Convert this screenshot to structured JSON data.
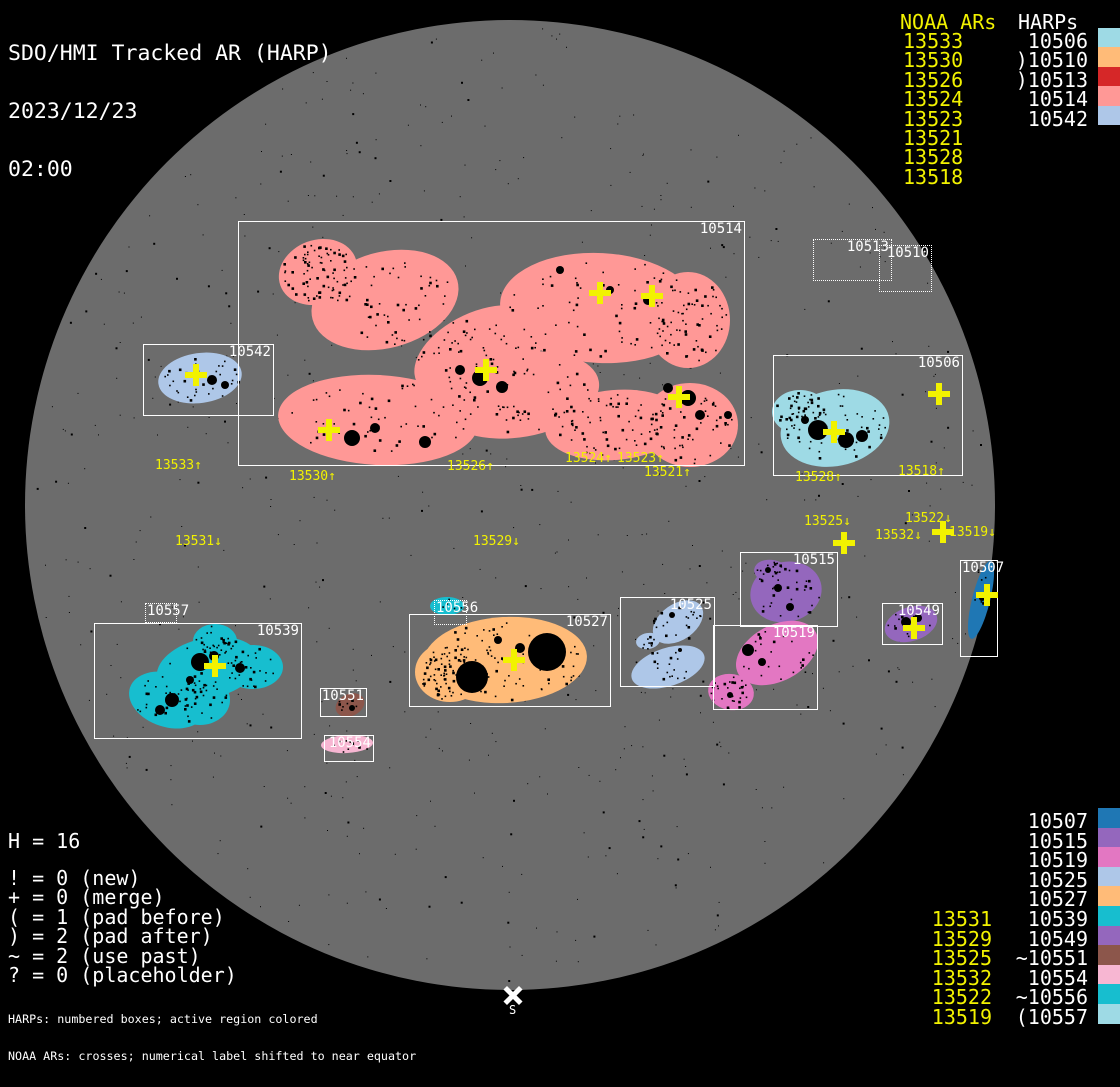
{
  "title": {
    "line1": "SDO/HMI Tracked AR (HARP)",
    "line2": "2023/12/23",
    "line3": "02:00"
  },
  "colors": {
    "background": "#000000",
    "disk": "#6c6c6c",
    "noaa_yellow": "#f2f200",
    "text_white": "#ffffff",
    "box_border": "#ffffff",
    "speckle": "#000000"
  },
  "legend_top_right": {
    "noaa_header": "NOAA ARs",
    "harp_header": "HARPs",
    "rows": [
      {
        "noaa": "13533",
        "harp": "10506",
        "color": "#9edae5"
      },
      {
        "noaa": "13530",
        "harp": ")10510",
        "color": "#ffbb78"
      },
      {
        "noaa": "13526",
        "harp": ")10513",
        "color": "#d62728"
      },
      {
        "noaa": "13524",
        "harp": "10514",
        "color": "#ff9896"
      },
      {
        "noaa": "13523",
        "harp": "10542",
        "color": "#aec7e8"
      },
      {
        "noaa": "13521",
        "harp": "",
        "color": ""
      },
      {
        "noaa": "13528",
        "harp": "",
        "color": ""
      },
      {
        "noaa": "13518",
        "harp": "",
        "color": ""
      }
    ]
  },
  "legend_bottom_right": {
    "rows": [
      {
        "noaa": "",
        "harp": "10507",
        "color": "#1f77b4"
      },
      {
        "noaa": "",
        "harp": "10515",
        "color": "#9467bd"
      },
      {
        "noaa": "",
        "harp": "10519",
        "color": "#e377c2"
      },
      {
        "noaa": "",
        "harp": "10525",
        "color": "#aec7e8"
      },
      {
        "noaa": "",
        "harp": "10527",
        "color": "#ffbb78"
      },
      {
        "noaa": "13531",
        "harp": "10539",
        "color": "#17becf"
      },
      {
        "noaa": "13529",
        "harp": "10549",
        "color": "#9467bd"
      },
      {
        "noaa": "13525",
        "harp": "~10551",
        "color": "#8c564b"
      },
      {
        "noaa": "13532",
        "harp": "10554",
        "color": "#f7b6d2"
      },
      {
        "noaa": "13522",
        "harp": "~10556",
        "color": "#17becf"
      },
      {
        "noaa": "13519",
        "harp": "(10557",
        "color": "#9edae5"
      }
    ]
  },
  "legend_bottom_left": {
    "harp_count": "H = 16",
    "lines": [
      "! = 0 (new)",
      "+ = 0 (merge)",
      "( = 1 (pad before)",
      ") = 2 (pad after)",
      "~ = 2 (use past)",
      "? = 0 (placeholder)"
    ]
  },
  "footer": {
    "line1": "HARPs: numbered boxes; active region colored",
    "line2": "NOAA ARs: crosses; numerical label shifted to near equator"
  },
  "south_marker": {
    "label": "S",
    "x": 513,
    "y": 995
  },
  "chart_data": {
    "type": "scatter",
    "title": "SDO/HMI Tracked AR (HARP)",
    "datetime": "2023/12/23 02:00",
    "counts": {
      "H": 16,
      "new": 0,
      "merge": 0,
      "pad_before": 1,
      "pad_after": 2,
      "use_past": 2,
      "placeholder": 0
    },
    "disk": {
      "cx": 510,
      "cy": 505,
      "r": 485
    },
    "regions": [
      {
        "harp": "10514",
        "color": "#ff9896",
        "border": "solid",
        "box": [
          238,
          221,
          507,
          245
        ],
        "label_pos": "tr"
      },
      {
        "harp": "10542",
        "color": "#aec7e8",
        "border": "solid",
        "box": [
          143,
          344,
          131,
          72
        ],
        "label_pos": "tr"
      },
      {
        "harp": "10506",
        "color": "#9edae5",
        "border": "solid",
        "box": [
          773,
          355,
          190,
          121
        ],
        "label_pos": "tr"
      },
      {
        "harp": "10513",
        "color": "#d62728",
        "border": "dashed",
        "box": [
          813,
          239,
          79,
          42
        ],
        "label_pos": "tr"
      },
      {
        "harp": "10510",
        "color": "#ffbb78",
        "border": "dashed",
        "box": [
          879,
          245,
          53,
          47
        ],
        "label_pos": "tr"
      },
      {
        "harp": "10515",
        "color": "#9467bd",
        "border": "solid",
        "box": [
          740,
          552,
          98,
          75
        ],
        "label_pos": "tr"
      },
      {
        "harp": "10549",
        "color": "#9467bd",
        "border": "solid",
        "box": [
          882,
          603,
          61,
          42
        ],
        "label_pos": "tr"
      },
      {
        "harp": "10507",
        "color": "#1f77b4",
        "border": "solid",
        "box": [
          960,
          560,
          38,
          97
        ],
        "label_pos": "tl"
      },
      {
        "harp": "10519",
        "color": "#e377c2",
        "border": "solid",
        "box": [
          713,
          625,
          105,
          85
        ],
        "label_pos": "tr"
      },
      {
        "harp": "10525",
        "color": "#aec7e8",
        "border": "solid",
        "box": [
          620,
          597,
          95,
          90
        ],
        "label_pos": "tr"
      },
      {
        "harp": "10527",
        "color": "#ffbb78",
        "border": "solid",
        "box": [
          409,
          614,
          202,
          93
        ],
        "label_pos": "tr"
      },
      {
        "harp": "10556",
        "color": "#17becf",
        "border": "dashed",
        "box": [
          434,
          600,
          33,
          25
        ],
        "label_pos": "tl"
      },
      {
        "harp": "10539",
        "color": "#17becf",
        "border": "solid",
        "box": [
          94,
          623,
          208,
          116
        ],
        "label_pos": "tr"
      },
      {
        "harp": "10557",
        "color": "#9edae5",
        "border": "dashed",
        "box": [
          145,
          603,
          32,
          20
        ],
        "label_pos": "tl"
      },
      {
        "harp": "10551",
        "color": "#8c564b",
        "border": "solid",
        "box": [
          320,
          688,
          47,
          29
        ],
        "label_pos": "tr"
      },
      {
        "harp": "10554",
        "color": "#f7b6d2",
        "border": "solid",
        "box": [
          324,
          735,
          50,
          27
        ],
        "label_pos": "tr"
      }
    ],
    "noaa_crosses": [
      [
        600,
        293
      ],
      [
        652,
        296
      ],
      [
        486,
        370
      ],
      [
        679,
        397
      ],
      [
        329,
        430
      ],
      [
        196,
        375
      ],
      [
        834,
        432
      ],
      [
        939,
        394
      ],
      [
        844,
        543
      ],
      [
        943,
        532
      ],
      [
        914,
        628
      ],
      [
        987,
        595
      ],
      [
        215,
        666
      ],
      [
        514,
        660
      ]
    ],
    "ar_labels": [
      {
        "text": "13533↑",
        "x": 155,
        "y": 460
      },
      {
        "text": "13530↑",
        "x": 289,
        "y": 471
      },
      {
        "text": "13526↑",
        "x": 447,
        "y": 461
      },
      {
        "text": "13524↑",
        "x": 565,
        "y": 453
      },
      {
        "text": "13523↑",
        "x": 617,
        "y": 453
      },
      {
        "text": "13521↑",
        "x": 644,
        "y": 467
      },
      {
        "text": "13528↑",
        "x": 795,
        "y": 472
      },
      {
        "text": "13518↑",
        "x": 898,
        "y": 466
      },
      {
        "text": "13525↓",
        "x": 804,
        "y": 516
      },
      {
        "text": "13522↓",
        "x": 905,
        "y": 513
      },
      {
        "text": "13532↓",
        "x": 875,
        "y": 530
      },
      {
        "text": "13519↓",
        "x": 949,
        "y": 527
      },
      {
        "text": "13531↓",
        "x": 175,
        "y": 536
      },
      {
        "text": "13529↓",
        "x": 473,
        "y": 536
      }
    ]
  }
}
